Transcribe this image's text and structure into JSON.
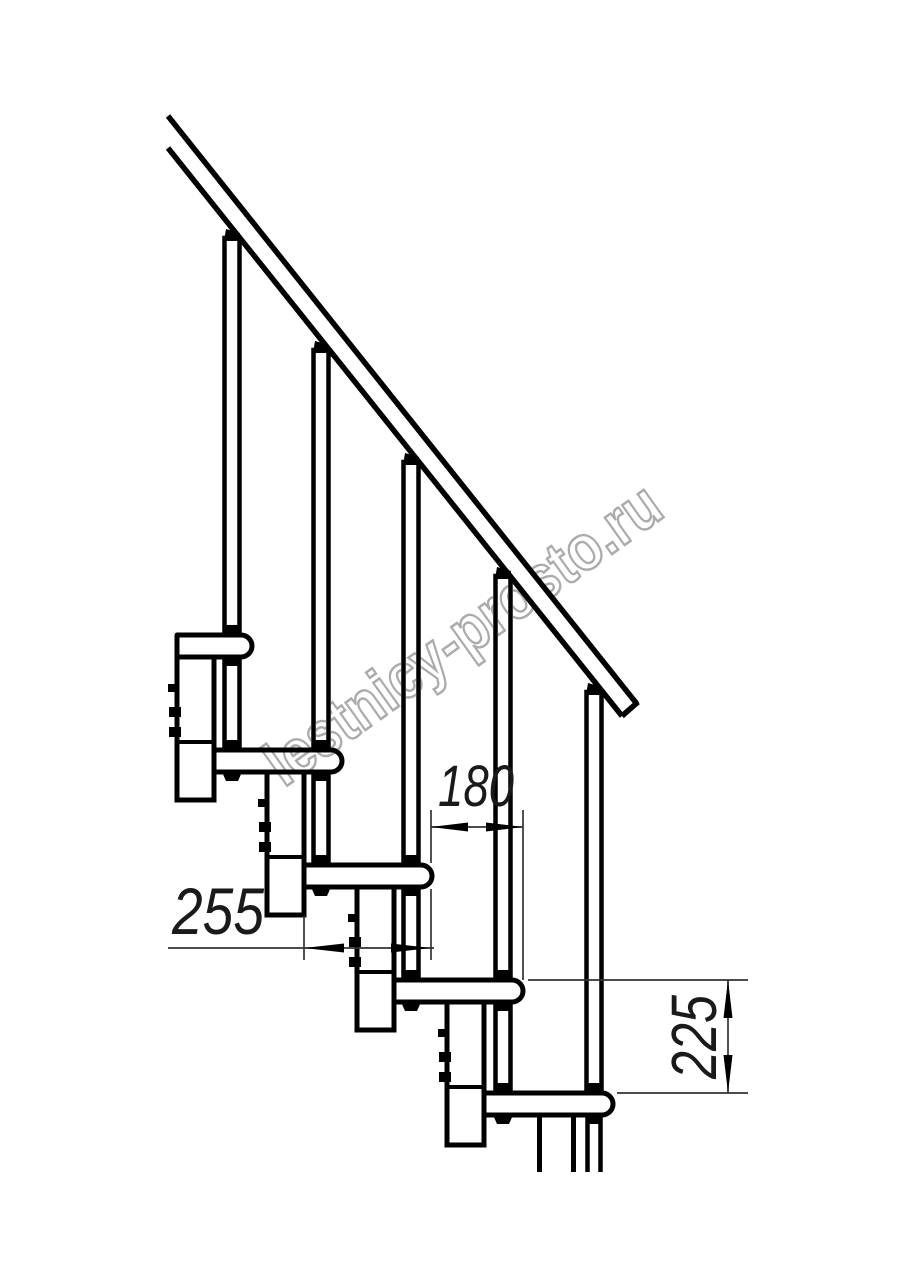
{
  "page": {
    "title": "Staircase module side view drawing",
    "background": "#ffffff"
  },
  "watermark": {
    "text": "lestnicy-prosto.ru",
    "color": "#ababab"
  },
  "drawing": {
    "line_color": "#000000",
    "components": {
      "handrail": 1,
      "balusters": 5,
      "treads": 5,
      "support_modules": 5
    },
    "dimensions": [
      {
        "id": "tread-depth",
        "value": "255",
        "orientation": "horizontal"
      },
      {
        "id": "step-run",
        "value": "180",
        "orientation": "horizontal"
      },
      {
        "id": "step-rise",
        "value": "225",
        "orientation": "vertical"
      }
    ]
  }
}
